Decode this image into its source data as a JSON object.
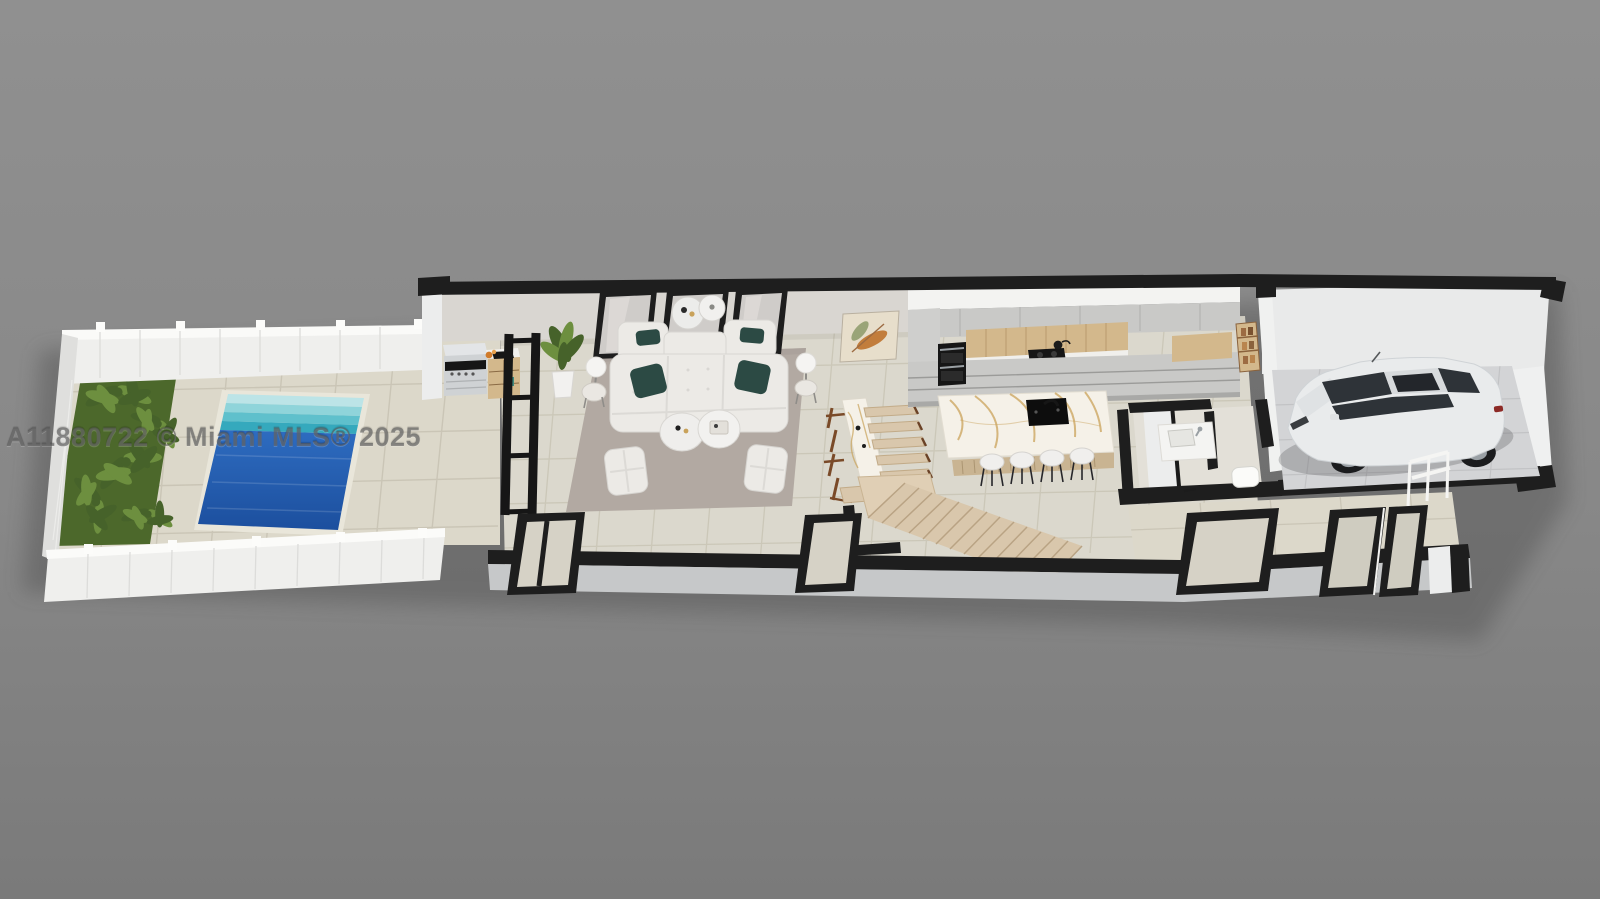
{
  "watermark": {
    "text": "A11880722 © Miami MLS® 2025"
  },
  "scene": {
    "kind": "3d-rendered-floor-plan",
    "labels": [
      "backyard",
      "garden",
      "pool",
      "patio",
      "outdoor-kitchen",
      "glass-partition",
      "living-room",
      "dining-area",
      "kitchen",
      "kitchen-island",
      "staircase",
      "powder-room",
      "pantry-closet",
      "garage",
      "car",
      "entry-door",
      "front-wall"
    ],
    "colors": {
      "bgTop": "#8e8e8e",
      "bgBottom": "#7b7b7b",
      "tile": "#dcd8ca",
      "tileInner": "#dbd8cd",
      "grout": "#c6c1b0",
      "wallBlack": "#1e1e1e",
      "wallWhite": "#eceded",
      "wallGreige": "#d9d6d1",
      "wallFaceGray": "#c6c8c9",
      "fence": "#efefed",
      "fenceShade": "#dfdfdd",
      "grass": "#4c682b",
      "palmDark": "#46622a",
      "palmLight": "#6d8f3f",
      "poolDeep": "#1d55a9",
      "poolLight": "#2e6cc0",
      "poolStep1": "#bce4e7",
      "poolStep2": "#8fd4da",
      "poolStep3": "#5fc0cc",
      "poolStep4": "#35a9bd",
      "rug": "#b2a9a2",
      "sofa": "#eceae6",
      "pillow": "#2c4a44",
      "woodLight": "#d3b88c",
      "woodMid": "#c9b492",
      "woodDark": "#7a4a28",
      "stair": "#d9c7ac",
      "stairEdge": "#b9a384",
      "marble": "#f5f1e8",
      "vein": "#c9a25a",
      "cabinet": "#c9c9c7",
      "appliance": "#161616",
      "concrete": "#d3d4d6",
      "car": "#e9ebec",
      "carGlass": "#2e3338",
      "canvas": "#e7decb",
      "artLeaf": "#c27d3c",
      "artLeaf2": "#9aa478",
      "watermark": "rgba(90,90,90,0.62)"
    }
  }
}
